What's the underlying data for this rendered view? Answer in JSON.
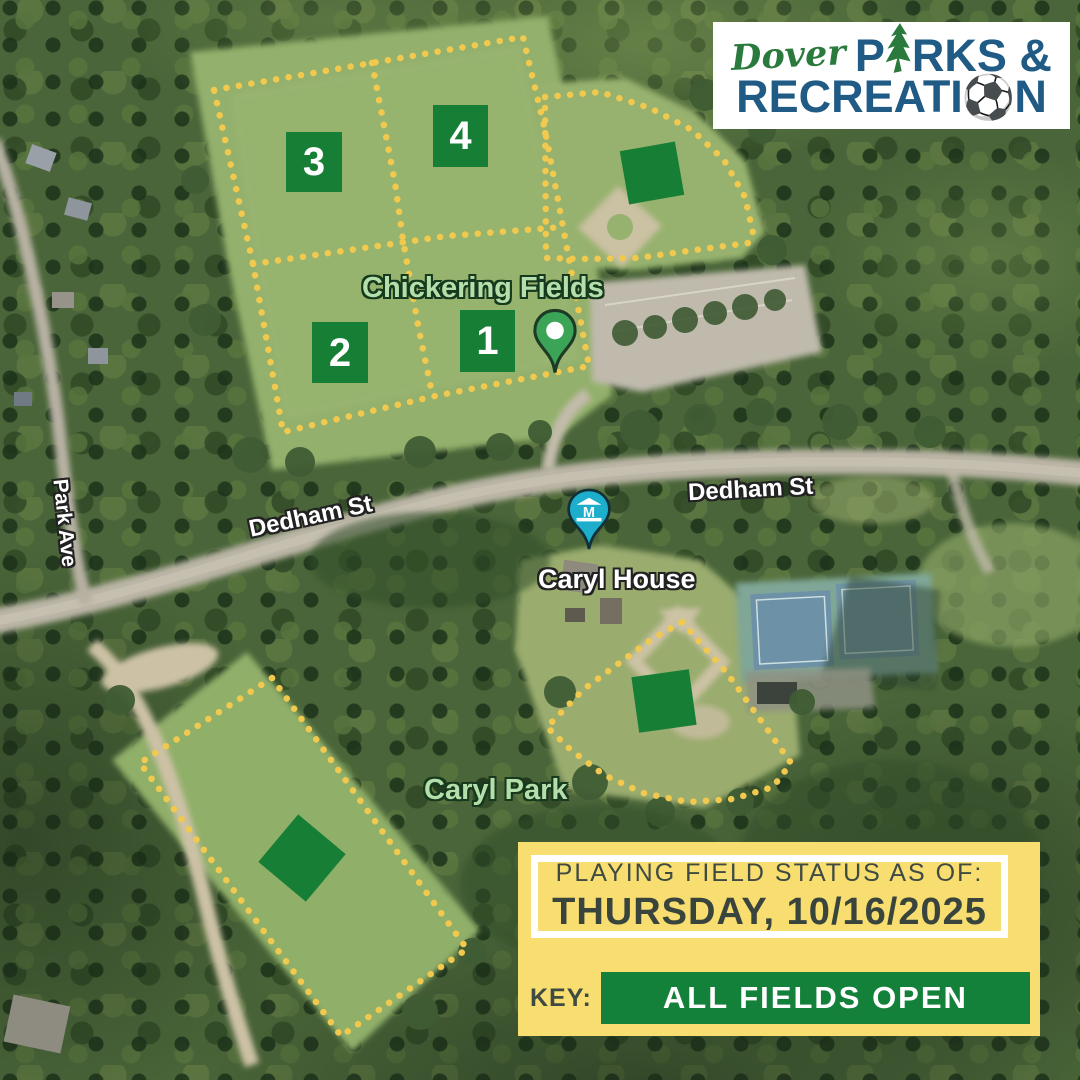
{
  "logo": {
    "city": "Dover",
    "parks_before_tree": "P",
    "parks_after_tree": "RKS &",
    "recreation_before_ball": "RECREATI",
    "recreation_after_ball": "N",
    "soccer_ball_glyph": "⚽"
  },
  "map": {
    "park_label_chickering": "Chickering Fields",
    "park_label_caryl": "Caryl Park",
    "poi_label_caryl_house": "Caryl House",
    "road_label_dedham_west": "Dedham St",
    "road_label_dedham_east": "Dedham St",
    "road_label_park_ave": "Park Ave"
  },
  "markers": {
    "f1": "1",
    "f2": "2",
    "f3": "3",
    "f4": "4"
  },
  "status_panel": {
    "title": "PLAYING FIELD STATUS AS OF:",
    "date": "THURSDAY, 10/16/2025",
    "key_label": "KEY:",
    "key_value": "ALL FIELDS OPEN"
  },
  "colors": {
    "field_open_green": "#177E36",
    "outline_dots_yellow": "#F2C94F",
    "panel_yellow": "#F8DE70",
    "panel_text_dark": "#3E4A42",
    "logo_blue": "#1F5B84",
    "logo_green": "#2B7A3D",
    "green_pin": "#3BA457",
    "museum_pin_teal": "#1CAECB"
  }
}
